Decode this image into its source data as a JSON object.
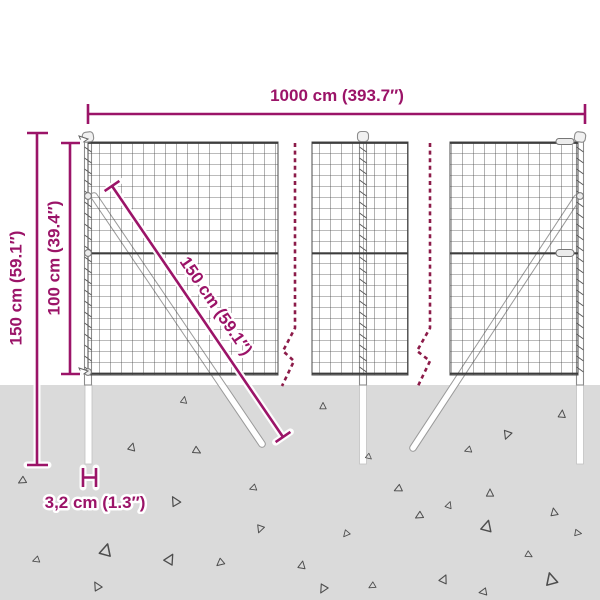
{
  "diagram": {
    "title": "wire-mesh-fence-dimension-diagram",
    "labels": {
      "total_width": "1000 cm (393.7″)",
      "total_height": "150 cm (59.1″)",
      "fence_height": "100 cm (39.4″)",
      "brace_length": "150 cm (59.1″)",
      "post_width": "3,2 cm (1.3″)"
    }
  },
  "colors": {
    "dimension": "#9B1468",
    "break_line": "#8C1B49",
    "ground": "#DADADA",
    "mesh": "#4A4A4A",
    "wire": "#3C3C3C",
    "post_outline": "#8C8C8C",
    "debris": "#4D4D4D",
    "background": "#FFFFFF"
  },
  "ground": {
    "triangles": [
      [
        184,
        400,
        10,
        0.8
      ],
      [
        323,
        406,
        0,
        0.8
      ],
      [
        562,
        414,
        5,
        0.9
      ],
      [
        507,
        435,
        200,
        1.0
      ],
      [
        132,
        447,
        15,
        0.9
      ],
      [
        197,
        451,
        120,
        0.9
      ],
      [
        468,
        450,
        250,
        0.8
      ],
      [
        369,
        457,
        130,
        0.7
      ],
      [
        22,
        481,
        240,
        0.9
      ],
      [
        253,
        488,
        250,
        0.8
      ],
      [
        398,
        489,
        245,
        0.9
      ],
      [
        490,
        493,
        0,
        0.9
      ],
      [
        175,
        501,
        330,
        1.1
      ],
      [
        449,
        505,
        20,
        0.8
      ],
      [
        554,
        512,
        350,
        0.9
      ],
      [
        419,
        516,
        240,
        0.9
      ],
      [
        260,
        529,
        200,
        0.9
      ],
      [
        346,
        534,
        220,
        0.8
      ],
      [
        487,
        526,
        15,
        1.3
      ],
      [
        551,
        579,
        345,
        1.4
      ],
      [
        97,
        586,
        330,
        1.0
      ],
      [
        36,
        560,
        250,
        0.8
      ],
      [
        106,
        550,
        15,
        1.4
      ],
      [
        170,
        559,
        30,
        1.2
      ],
      [
        220,
        563,
        230,
        0.9
      ],
      [
        302,
        565,
        10,
        0.9
      ],
      [
        323,
        589,
        210,
        1.0
      ],
      [
        372,
        586,
        240,
        0.8
      ],
      [
        444,
        579,
        25,
        1.0
      ],
      [
        483,
        592,
        260,
        0.9
      ],
      [
        529,
        555,
        120,
        0.8
      ],
      [
        578,
        533,
        100,
        0.8
      ]
    ]
  }
}
